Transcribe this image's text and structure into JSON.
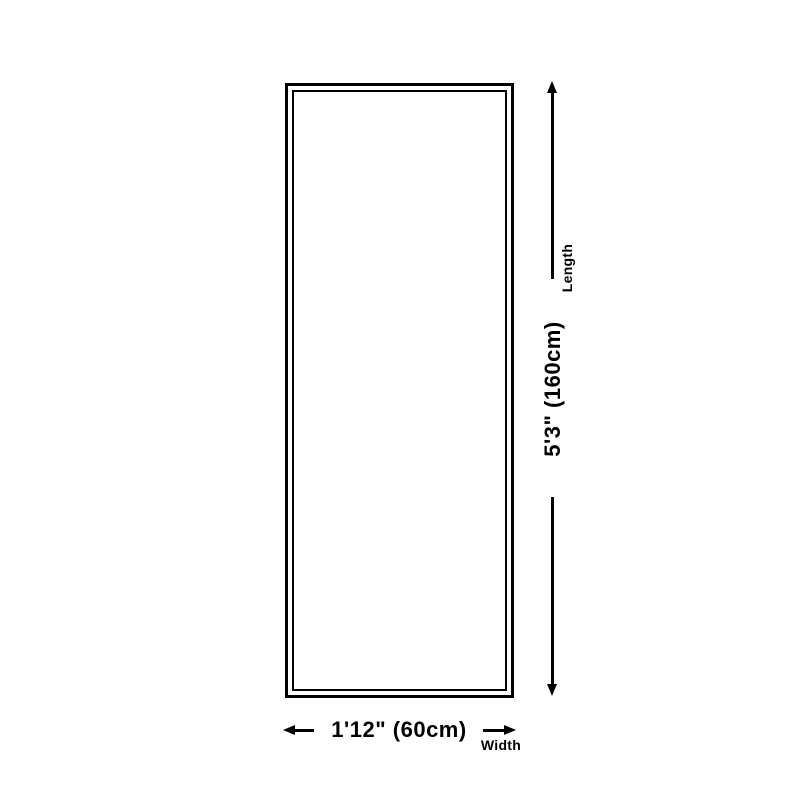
{
  "colors": {
    "background": "#ffffff",
    "line": "#000000",
    "text": "#000000"
  },
  "diagram": {
    "type": "product-dimension-diagram",
    "length": {
      "label": "Length",
      "value": "5'3\" (160cm)"
    },
    "width": {
      "label": "Width",
      "value": "1'12\" (60cm)"
    }
  },
  "icons": {
    "length_arrow_up": "arrow-up-icon",
    "length_arrow_down": "arrow-down-icon",
    "width_arrow_left": "arrow-left-icon",
    "width_arrow_right": "arrow-right-icon"
  }
}
